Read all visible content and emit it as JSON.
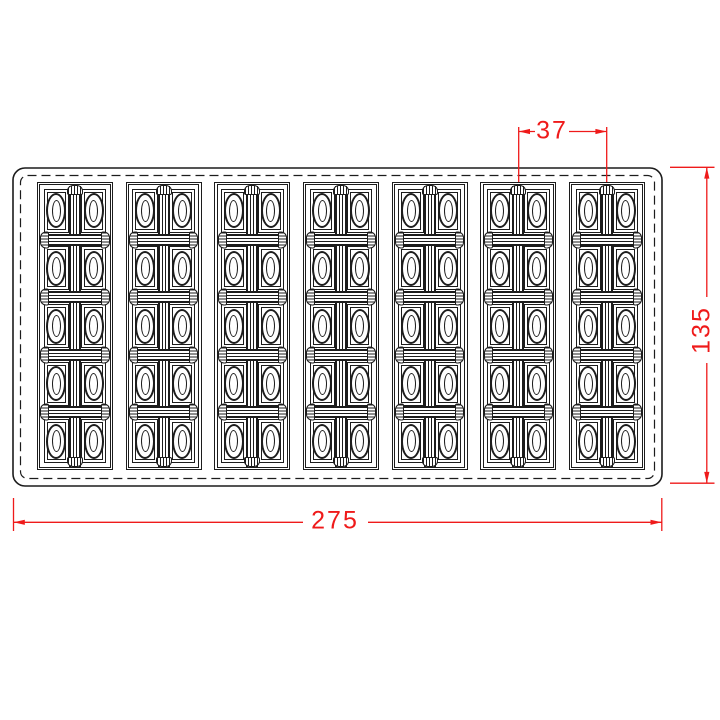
{
  "drawing": {
    "grid": {
      "columns": 7,
      "rows": 5,
      "cells_per_row": 2
    },
    "dimensions": [
      {
        "id": "column-pitch",
        "label": "37",
        "orientation": "horizontal"
      },
      {
        "id": "overall-width",
        "label": "275",
        "orientation": "horizontal"
      },
      {
        "id": "overall-height",
        "label": "135",
        "orientation": "vertical"
      }
    ],
    "colors": {
      "line": "#1c1c1c",
      "dimension": "#ef1a1a",
      "background": "#ffffff"
    }
  }
}
